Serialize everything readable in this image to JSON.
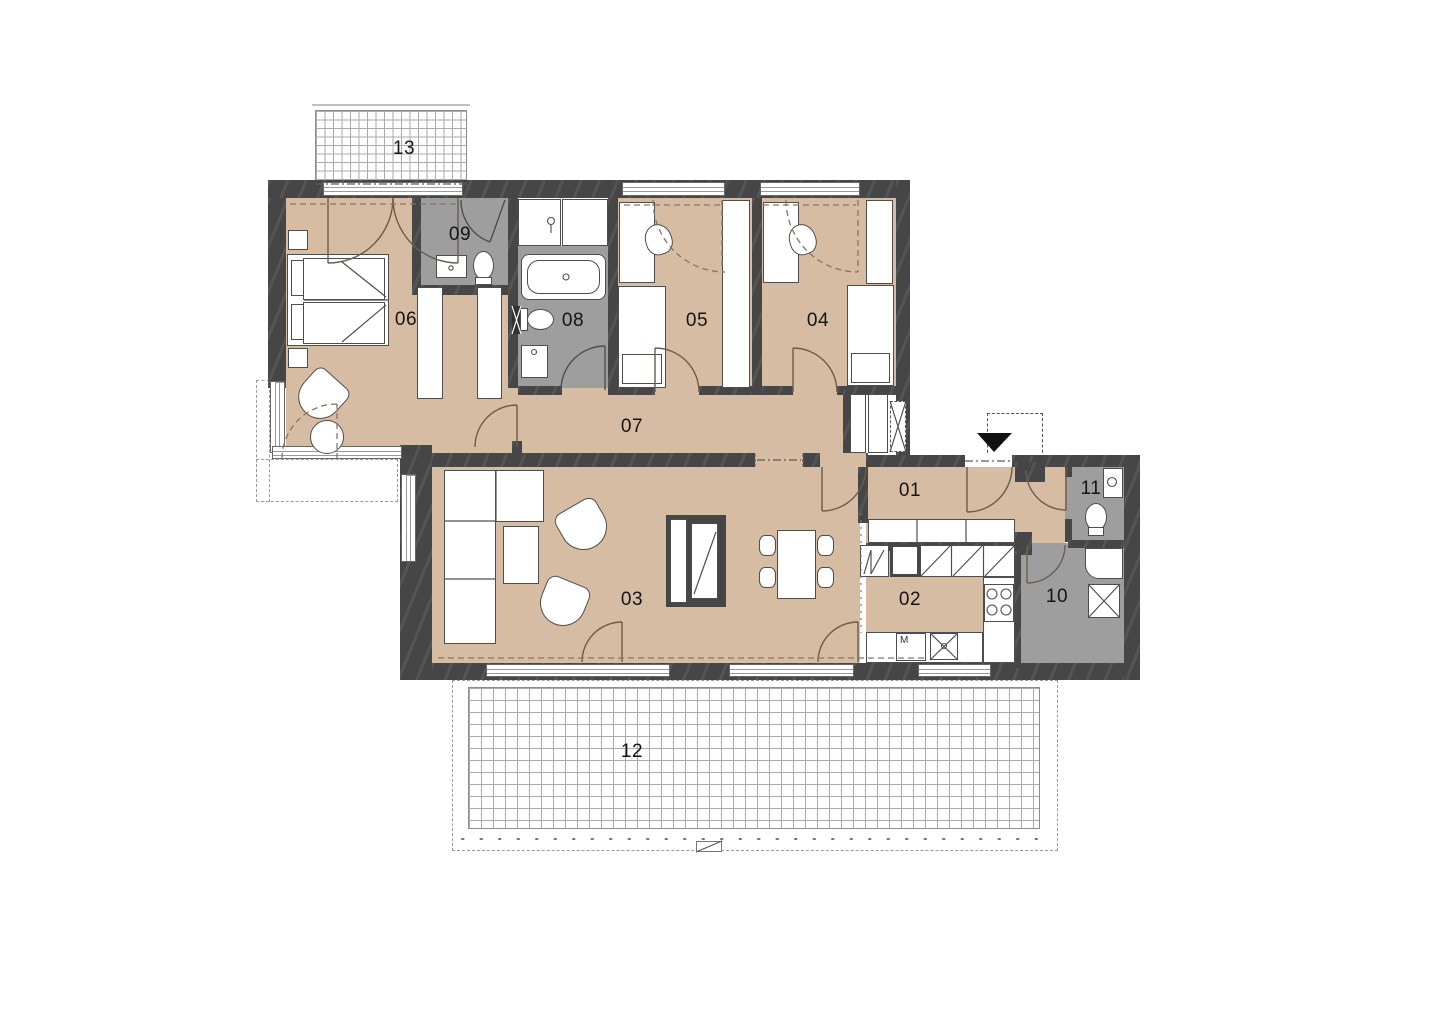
{
  "rooms": {
    "r01": {
      "label": "01"
    },
    "r02": {
      "label": "02"
    },
    "r03": {
      "label": "03"
    },
    "r04": {
      "label": "04"
    },
    "r05": {
      "label": "05"
    },
    "r06": {
      "label": "06"
    },
    "r07": {
      "label": "07"
    },
    "r08": {
      "label": "08"
    },
    "r09": {
      "label": "09"
    },
    "r10": {
      "label": "10"
    },
    "r11": {
      "label": "11"
    },
    "r12": {
      "label": "12"
    },
    "r13": {
      "label": "13"
    }
  },
  "kitchen": {
    "appliance_label": "M"
  },
  "colors": {
    "floor_dry": "#d6bca3",
    "floor_wet": "#9e9e9e",
    "wall": "#464646",
    "furniture": "#ffffff"
  }
}
